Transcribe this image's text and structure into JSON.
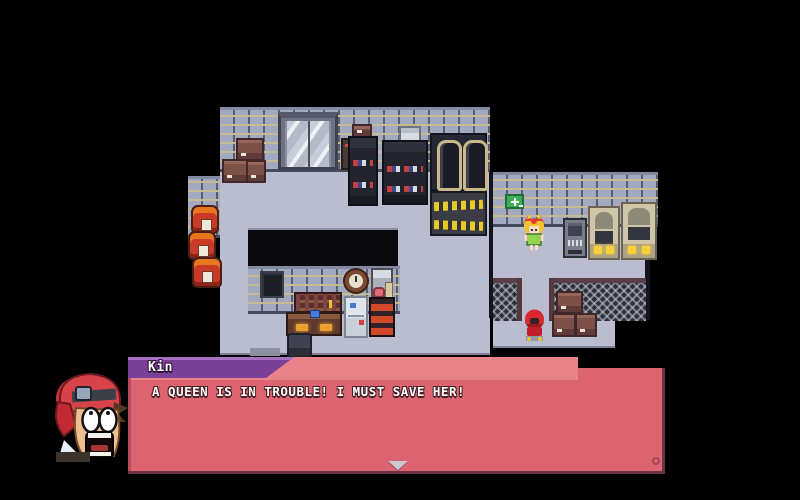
{
  "app": {
    "type": "rpg-game-screen",
    "location": "warehouse-interior"
  },
  "dialog": {
    "speaker": "Kin",
    "text": "A QUEEN IS IN TROUBLE! I MUST SAVE HER!",
    "continue_icon": "down-arrow-icon",
    "corner_icon": "circle-indicator-icon",
    "colors": {
      "body": "#dc6470",
      "body_light": "#e8828b",
      "nameplate": "#7a3f96",
      "nameplate_highlight": "#a673c2",
      "edge_dark": "#6b3440",
      "text": "#ffffff"
    }
  },
  "portrait": {
    "character": "kin-shocked-boy-red-cap"
  },
  "scene": {
    "colors": {
      "background": "#000000",
      "floor": "#b9bdcf",
      "brick": "#a3aabf",
      "mortar": "#c6ba92",
      "fence": "#2c2e38",
      "barrel": "#c93b26",
      "crate": "#7d5048",
      "chain": "#e7cb28",
      "sign_green": "#3fae5a"
    },
    "sprites": [
      "elevator",
      "crates",
      "barrels",
      "storage-shelves",
      "capsule-machines",
      "chained-crates",
      "black-counter",
      "wall-monitor",
      "wall-clock",
      "wall-cabinet",
      "pegboard",
      "desk",
      "office-chair",
      "fridge",
      "red-shelf",
      "first-aid-sign",
      "npc-girl",
      "computer-terminal",
      "power-machines",
      "chain-fence",
      "npc-red-kid"
    ]
  }
}
